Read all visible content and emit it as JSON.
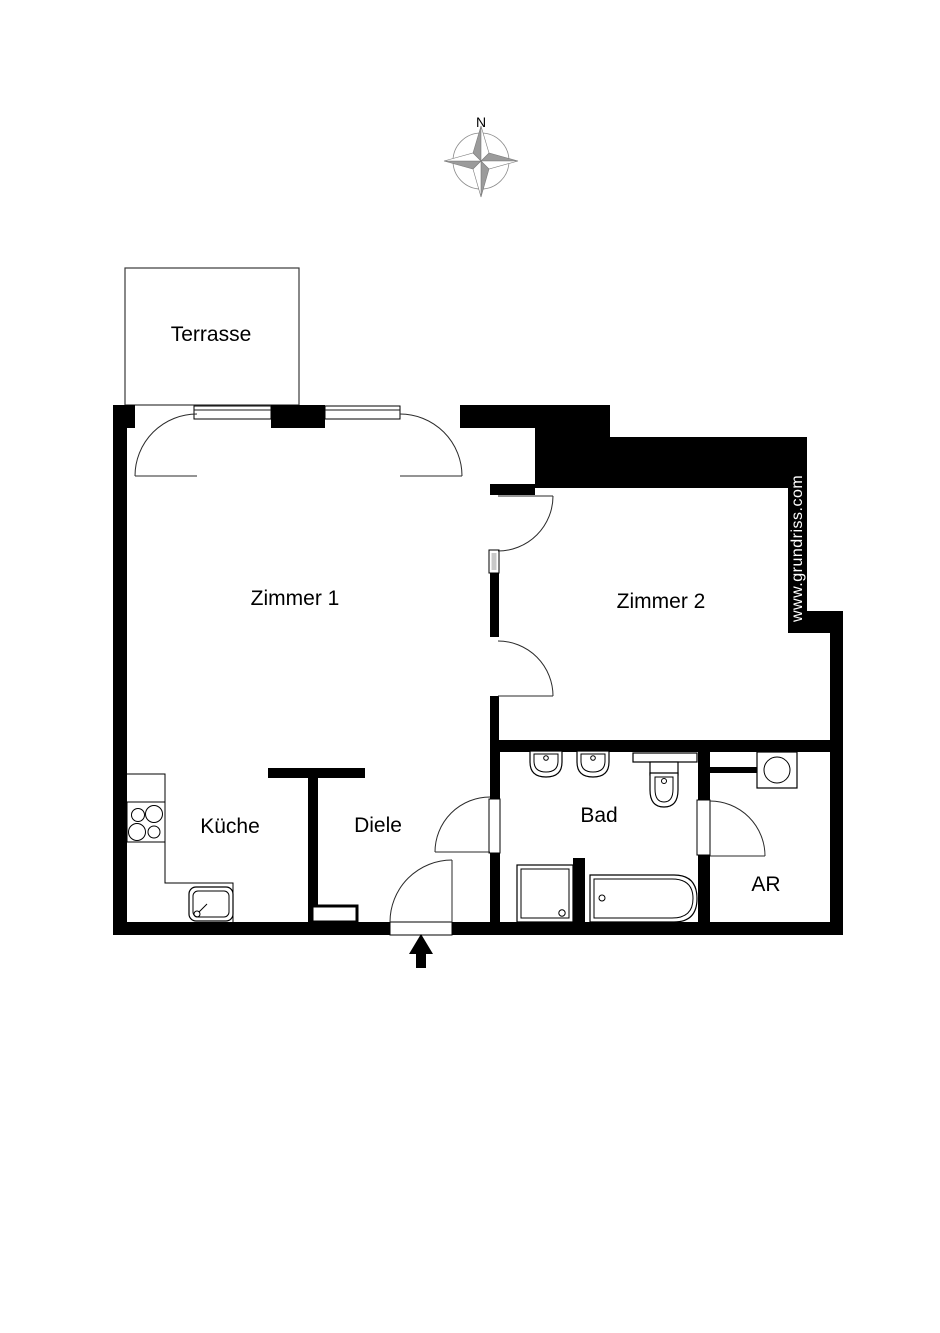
{
  "colors": {
    "wall": "#000000",
    "outline": "#1a1a1a",
    "background": "#ffffff",
    "compass_fill": "#9b9b9b",
    "watermark_text": "#ffffff"
  },
  "compass": {
    "north_label": "N"
  },
  "watermark": {
    "text": "www.grundriss.com"
  },
  "rooms": {
    "terrasse": {
      "label": "Terrasse"
    },
    "zimmer1": {
      "label": "Zimmer 1"
    },
    "zimmer2": {
      "label": "Zimmer 2"
    },
    "kueche": {
      "label": "Küche"
    },
    "diele": {
      "label": "Diele"
    },
    "bad": {
      "label": "Bad"
    },
    "ar": {
      "label": "AR"
    }
  }
}
